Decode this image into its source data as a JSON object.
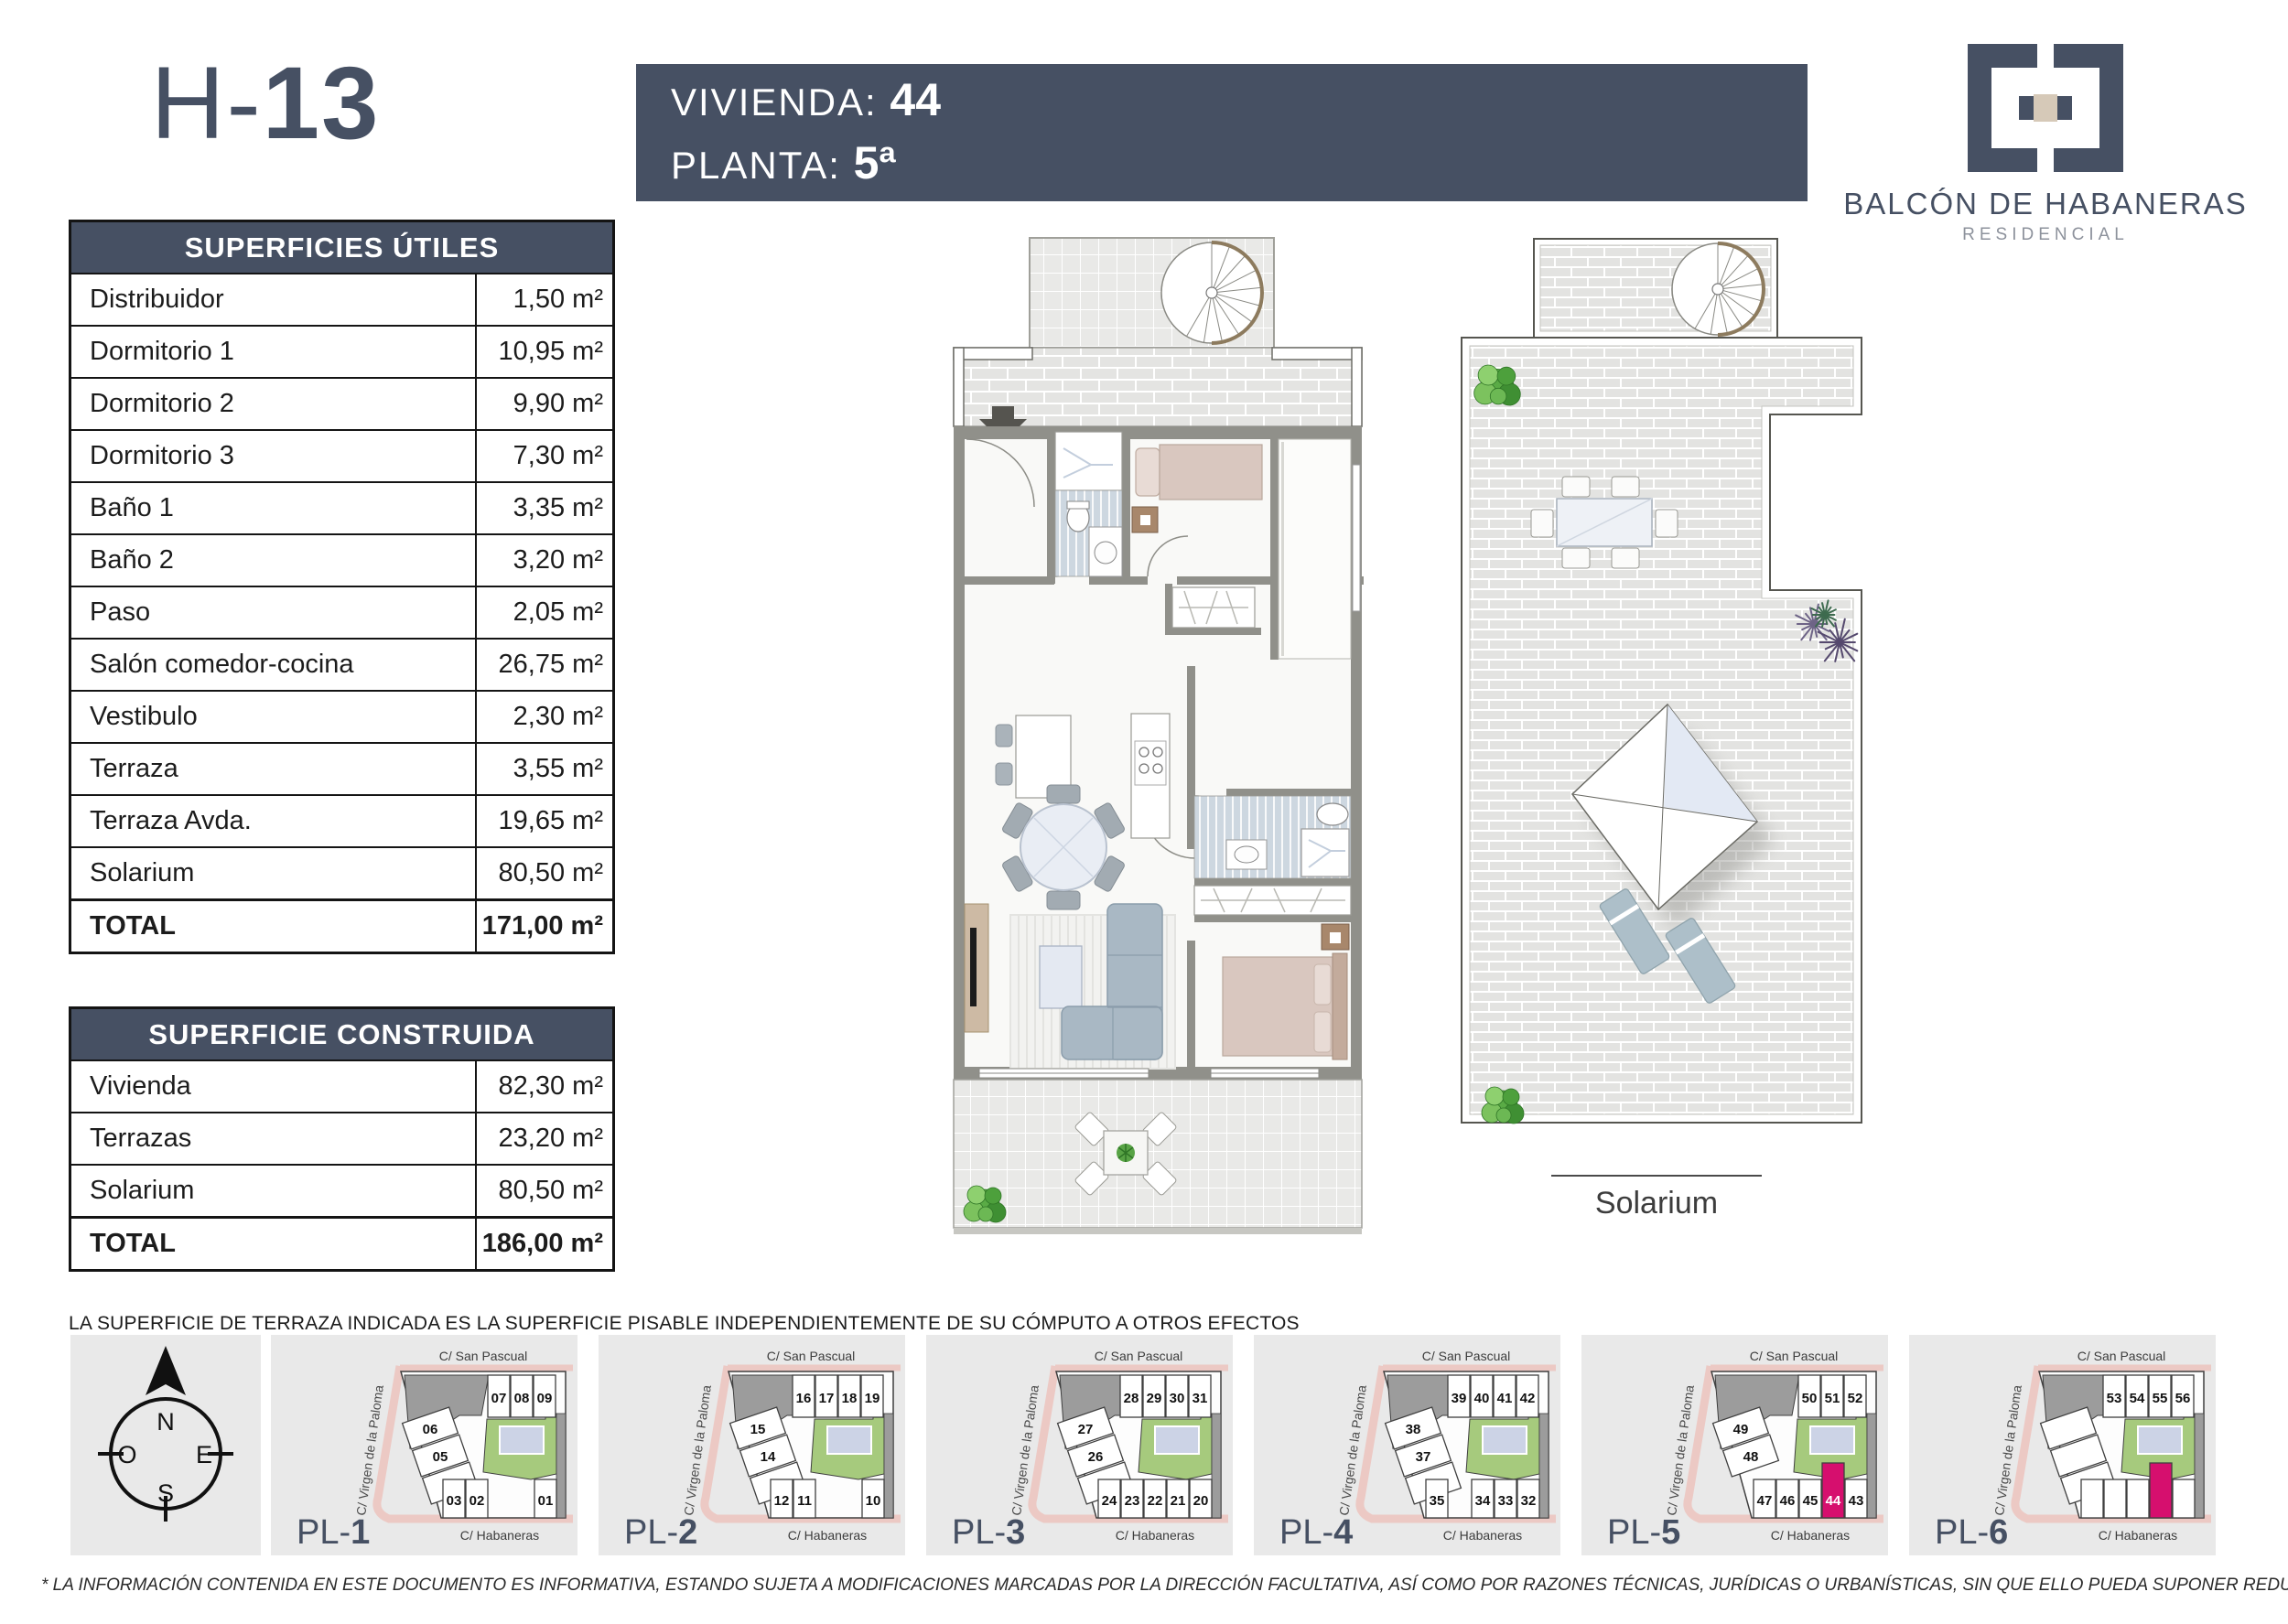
{
  "title": {
    "prefix": "H-",
    "number": "13"
  },
  "header": {
    "vivienda_label": "VIVIENDA:",
    "vivienda_value": "44",
    "planta_label": "PLANTA:",
    "planta_value": "5ª"
  },
  "logo": {
    "name": "BALCÓN DE HABANERAS",
    "subtitle": "RESIDENCIAL"
  },
  "tables": {
    "utiles": {
      "title": "SUPERFICIES ÚTILES",
      "rows": [
        {
          "label": "Distribuidor",
          "value": "1,50 m²"
        },
        {
          "label": "Dormitorio 1",
          "value": "10,95 m²"
        },
        {
          "label": "Dormitorio 2",
          "value": "9,90 m²"
        },
        {
          "label": "Dormitorio 3",
          "value": "7,30 m²"
        },
        {
          "label": "Baño 1",
          "value": "3,35 m²"
        },
        {
          "label": "Baño 2",
          "value": "3,20 m²"
        },
        {
          "label": "Paso",
          "value": "2,05 m²"
        },
        {
          "label": "Salón comedor-cocina",
          "value": "26,75 m²"
        },
        {
          "label": "Vestibulo",
          "value": "2,30 m²"
        },
        {
          "label": "Terraza",
          "value": "3,55 m²"
        },
        {
          "label": "Terraza Avda.",
          "value": "19,65 m²"
        },
        {
          "label": "Solarium",
          "value": "80,50 m²"
        }
      ],
      "total": {
        "label": "TOTAL",
        "value": "171,00 m²"
      }
    },
    "construida": {
      "title": "SUPERFICIE CONSTRUIDA",
      "rows": [
        {
          "label": "Vivienda",
          "value": "82,30 m²"
        },
        {
          "label": "Terrazas",
          "value": "23,20 m²"
        },
        {
          "label": "Solarium",
          "value": "80,50 m²"
        }
      ],
      "total": {
        "label": "TOTAL",
        "value": "186,00 m²"
      }
    }
  },
  "notes": {
    "terrace_note": "LA SUPERFICIE DE TERRAZA INDICADA ES LA SUPERFICIE PISABLE INDEPENDIENTEMENTE DE SU CÓMPUTO A OTROS EFECTOS",
    "legal_note": "* LA INFORMACIÓN CONTENIDA EN ESTE DOCUMENTO ES INFORMATIVA, ESTANDO SUJETA A MODIFICACIONES MARCADAS POR LA DIRECCIÓN FACULTATIVA, ASÍ COMO POR RAZONES TÉCNICAS, JURÍDICAS O URBANÍSTICAS, SIN QUE ELLO PUEDA SUPONER REDUCIR LAS CALIDADES INICIALMENTE PREVISTAS."
  },
  "solarium_label": "Solarium",
  "compass": {
    "n": "N",
    "e": "E",
    "s": "S",
    "o": "O"
  },
  "streets": {
    "top": "C/ San  Pascual",
    "left": "C/ Virgen de la Paloma",
    "bottom": "C/ Habaneras"
  },
  "pl_prefix": "PL-",
  "plans": [
    {
      "number": "1",
      "top_units": [
        "07",
        "08",
        "09"
      ],
      "diag_units": [
        "06",
        "05",
        "04"
      ],
      "bottom_groups": [
        [
          "03",
          "02"
        ],
        [
          "01"
        ]
      ]
    },
    {
      "number": "2",
      "top_units": [
        "16",
        "17",
        "18",
        "19"
      ],
      "diag_units": [
        "15",
        "14",
        "13"
      ],
      "bottom_groups": [
        [
          "12",
          "11"
        ],
        [
          "10"
        ]
      ]
    },
    {
      "number": "3",
      "top_units": [
        "28",
        "29",
        "30",
        "31"
      ],
      "diag_units": [
        "27",
        "26",
        "25"
      ],
      "bottom_groups": [
        [
          "24",
          "23",
          "22",
          "21",
          "20"
        ]
      ]
    },
    {
      "number": "4",
      "top_units": [
        "39",
        "40",
        "41",
        "42"
      ],
      "diag_units": [
        "38",
        "37",
        "36"
      ],
      "bottom_groups": [
        [
          "35"
        ],
        [
          "34",
          "33",
          "32"
        ]
      ]
    },
    {
      "number": "5",
      "top_units": [
        "50",
        "51",
        "52"
      ],
      "diag_units": [
        "49",
        "48"
      ],
      "bottom_groups": [
        [
          "47",
          "46",
          "45",
          "44",
          "43"
        ]
      ],
      "highlight_unit": "44"
    },
    {
      "number": "6",
      "top_units": [
        "53",
        "54",
        "55",
        "56"
      ],
      "diag_units": [
        "",
        "",
        ""
      ],
      "bottom_groups": [
        [
          "",
          "",
          "",
          "",
          ""
        ]
      ],
      "pink_slot": 3
    }
  ],
  "colors": {
    "accent": "#465063",
    "highlight": "#d60f6e",
    "courtyard_green": "#a6ca7d",
    "pool_blue": "#ccd3e6",
    "building_gray": "#9c9c9c",
    "street_pink": "#ecc9c4",
    "panel_bg": "#e9e9e9",
    "outline": "#3f3f3f"
  }
}
